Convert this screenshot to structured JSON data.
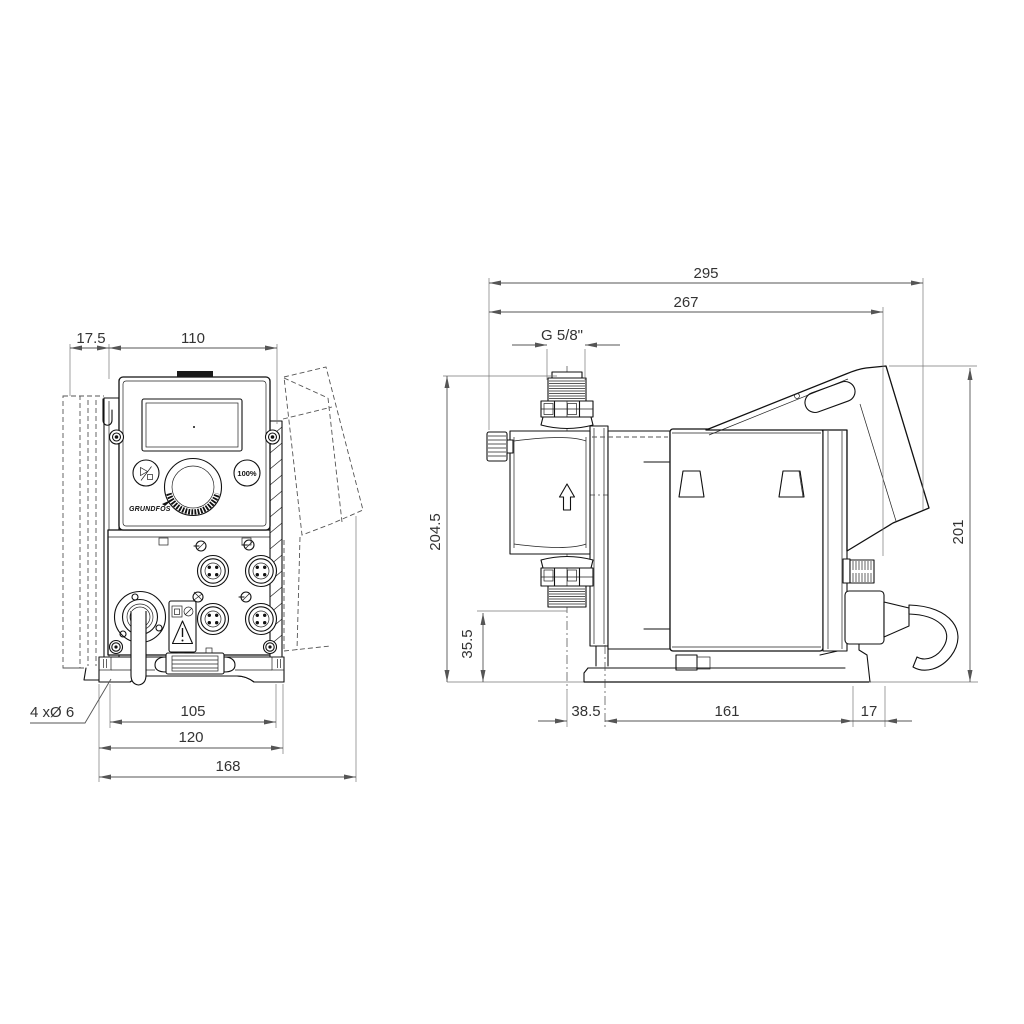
{
  "front": {
    "dim_17_5": "17.5",
    "dim_110": "110",
    "dim_105": "105",
    "dim_120": "120",
    "dim_168": "168",
    "holes_note": "4 xØ 6",
    "btn_100": "100%",
    "logo": "GRUNDFOS"
  },
  "side": {
    "dim_295": "295",
    "dim_267": "267",
    "thread": "G 5/8\"",
    "dim_204_5": "204.5",
    "dim_35_5": "35.5",
    "dim_38_5": "38.5",
    "dim_161": "161",
    "dim_17": "17",
    "dim_201": "201"
  },
  "colors": {
    "line": "#111111",
    "dimension": "#555555",
    "background": "#ffffff"
  }
}
